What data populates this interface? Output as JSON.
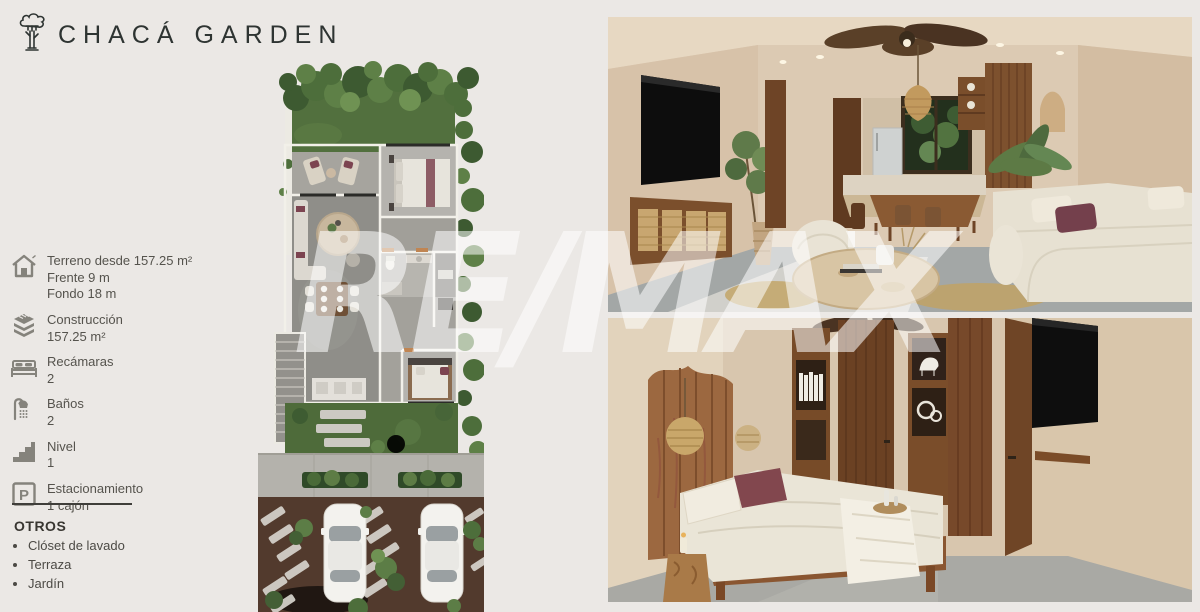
{
  "page": {
    "background_color": "#ebe8e5"
  },
  "header": {
    "title": "CHACÁ GARDEN",
    "logo_icon": "tree-icon"
  },
  "specs": {
    "parking_letter": "P",
    "items": [
      {
        "icon": "house-icon",
        "lines": [
          "Terreno desde 157.25 m²",
          "Frente 9 m",
          "Fondo 18 m"
        ]
      },
      {
        "icon": "construction-layers-icon",
        "lines": [
          "Construcción",
          "157.25 m²"
        ]
      },
      {
        "icon": "bed-icon",
        "lines": [
          "Recámaras",
          "2"
        ]
      },
      {
        "icon": "shower-icon",
        "lines": [
          "Baños",
          "2"
        ]
      },
      {
        "icon": "stairs-icon",
        "lines": [
          "Nivel",
          "1"
        ]
      },
      {
        "icon": "parking-icon",
        "lines": [
          "Estacionamiento",
          "1 cajón"
        ]
      }
    ],
    "others": {
      "title": "OTROS",
      "items": [
        "Clóset de lavado",
        "Terraza",
        "Jardín"
      ]
    }
  },
  "watermark": {
    "text": "RE/MAX",
    "color": "#ffffff",
    "opacity": 0.55
  },
  "floor_plan": {
    "alt": "top-down render: rear garden, terrace, two bedrooms, living-dining, kitchen, side stairs, front garden, sidewalk and driveway with two cars"
  },
  "photos": {
    "living_room": {
      "alt": "living room render with wall TV, rattan console, ceiling fan, cream sectional sofa, stone coffee table and kitchen with garden window"
    },
    "bedroom": {
      "alt": "bedroom render with live-edge wood headboard, rattan pendant lamps, walnut built-ins and wall TV"
    }
  }
}
